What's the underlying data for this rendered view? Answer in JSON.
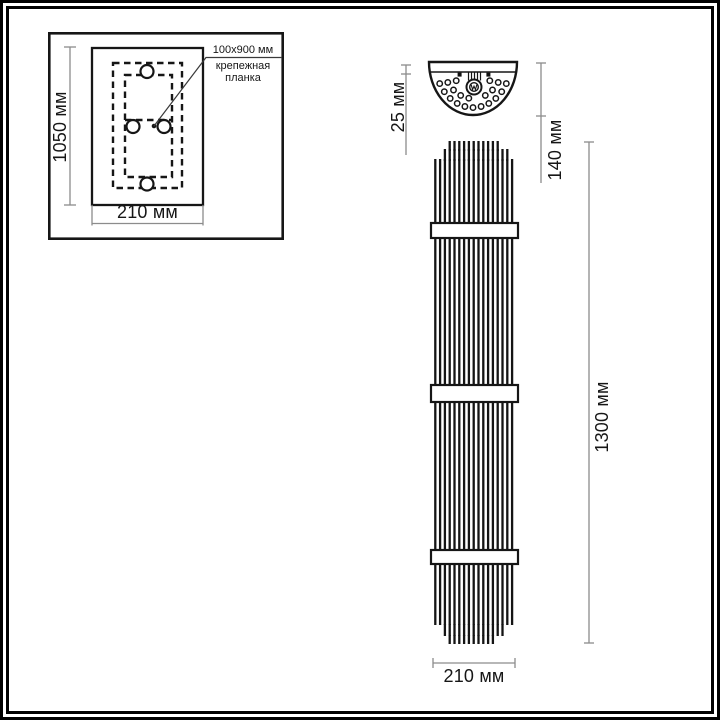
{
  "colors": {
    "background": "#ffffff",
    "ink": "#161616",
    "dimension_line": "#8c8c8c"
  },
  "mounting_plan": {
    "height_dimension": "1050 мм",
    "width_dimension": "210 мм",
    "callout_line1": "100x900 мм",
    "callout_line2": "крепежная",
    "callout_line3": "планка"
  },
  "front_view": {
    "plate_depth_dimension": "25 мм",
    "plate_height_dimension": "140 мм",
    "lamp_height_dimension": "1300 мм",
    "lamp_width_dimension": "210 мм"
  }
}
